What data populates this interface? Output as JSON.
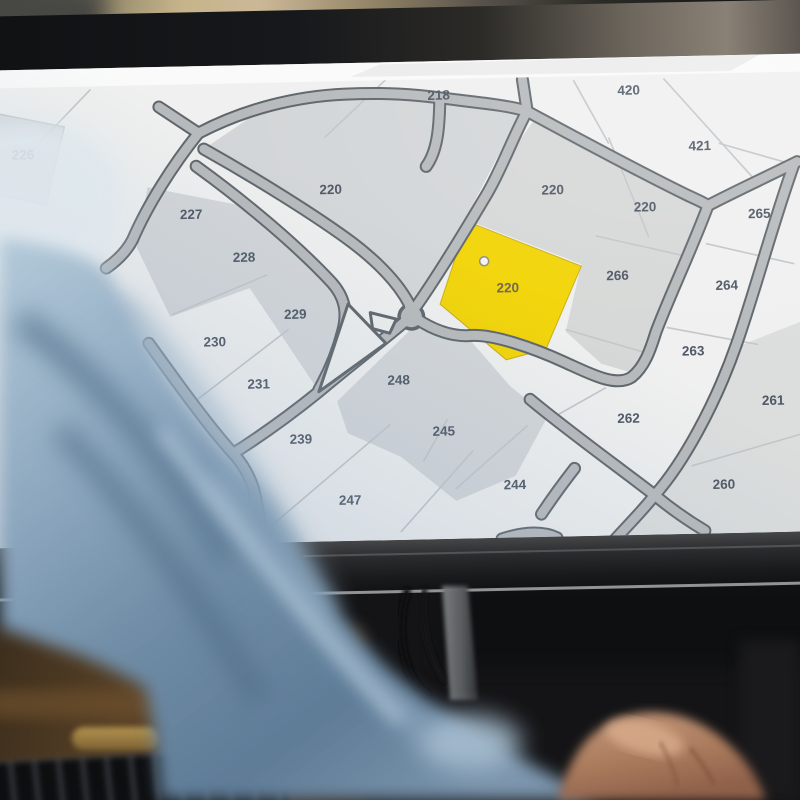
{
  "map": {
    "parcels": [
      {
        "label": "218"
      },
      {
        "label": "420"
      },
      {
        "label": "421"
      },
      {
        "label": "226"
      },
      {
        "label": "227"
      },
      {
        "label": "220"
      },
      {
        "label": "220"
      },
      {
        "label": "220"
      },
      {
        "label": "265"
      },
      {
        "label": "228"
      },
      {
        "label": "266"
      },
      {
        "label": "264"
      },
      {
        "label": "220"
      },
      {
        "label": "229"
      },
      {
        "label": "230"
      },
      {
        "label": "263"
      },
      {
        "label": "231"
      },
      {
        "label": "248"
      },
      {
        "label": "261"
      },
      {
        "label": "239"
      },
      {
        "label": "245"
      },
      {
        "label": "262"
      },
      {
        "label": "247"
      },
      {
        "label": "244"
      },
      {
        "label": "260"
      }
    ],
    "selected_parcel": {
      "label": "220",
      "fill": "#F2D405"
    },
    "cursor": {
      "icon": "cursor-dot"
    },
    "colors": {
      "map_background": "#EFF0EF",
      "parcel_gray": "#D3D6D8",
      "parcel_gray_light": "#DCDEDD",
      "road_fill": "#B7BABC",
      "road_casing": "#5F666B",
      "boundary_line": "#C2C6C9",
      "label_text": "#4E5764",
      "highlight": "#F2D405"
    }
  },
  "photo": {
    "sleeve_color": "#7F9AB5",
    "skin_color": "#C79B7E",
    "bezel_color": "#1F2023",
    "desk_wood_color": "#5A4226"
  }
}
